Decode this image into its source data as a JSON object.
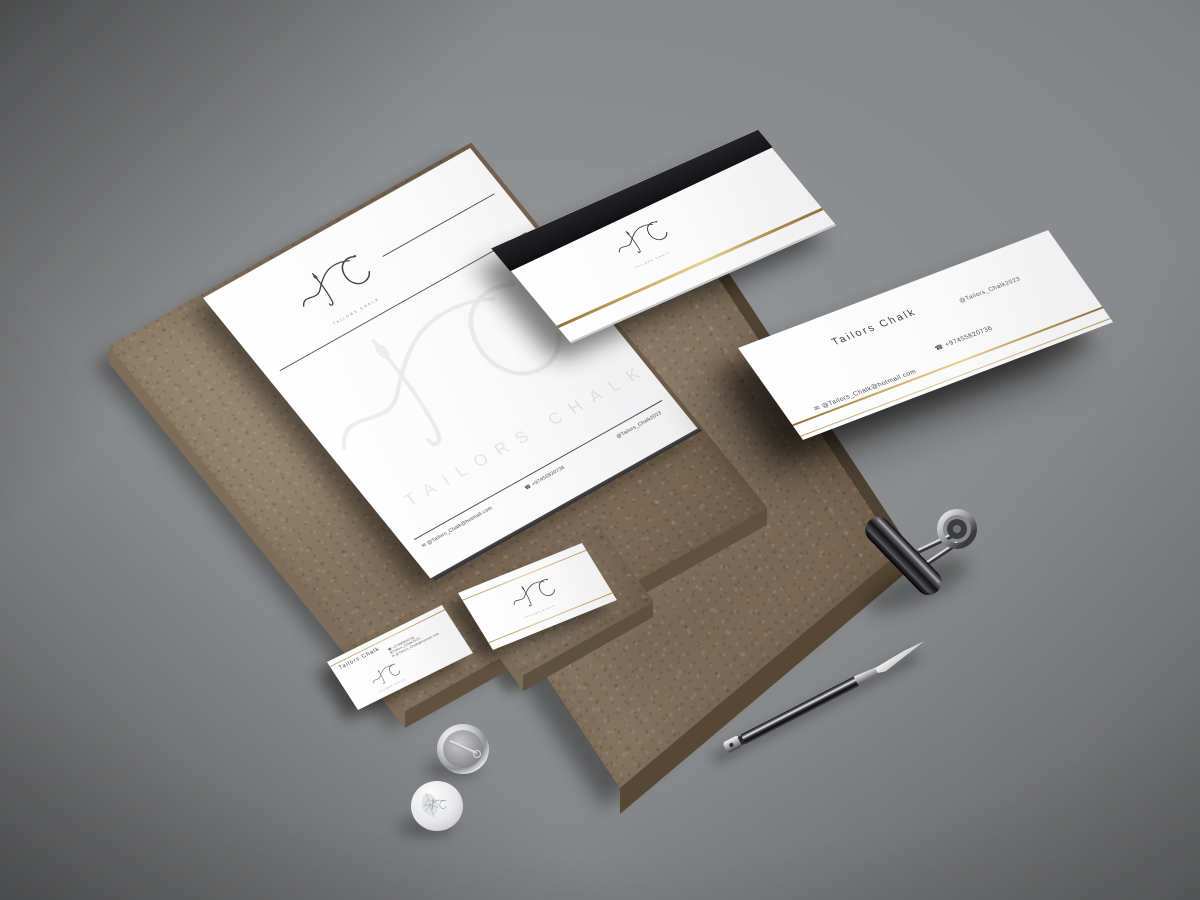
{
  "brand": {
    "name": "Tailors Chalk",
    "monogram": "TC",
    "social_handle": "@Tailors_Chalk2023",
    "phone": "+97455820736",
    "email": "@Tailors_Chalk@hotmail.com"
  },
  "letterhead": {
    "brand_subtitle": "Tailors Chalk",
    "watermark_name": "Tailors Chalk",
    "footer_email": "@Tailors_Chalk@hotmail.com",
    "footer_phone": "+97455820736",
    "footer_social": "@Tailors_Chalk2023"
  },
  "envelope": {
    "brand_subtitle": "Tailors Chalk"
  },
  "business_card_back": {
    "title": "Tailors Chalk",
    "social": "@Tailors_Chalk2023",
    "phone": "+97455820736",
    "email": "@Tailors_Chalk@hotmail.com"
  },
  "business_card_front": {
    "title": "Tailors Chalk",
    "phone": "+97455820736",
    "social": "@Tailors_Chalk2023",
    "email": "@Tailors_Chalk@hotmail.com",
    "brand_subtitle": "Tailors Chalk"
  },
  "business_card_logo_side": {
    "brand_subtitle": "Tailors Chalk"
  },
  "icons": {
    "phone_icon": "☎",
    "email_icon": "✉"
  },
  "colors": {
    "gold": "#c3a25f",
    "paper": "#ffffff",
    "stone": "#8d7b68",
    "background": "#87898b",
    "envelope_flap": "#1c1c1e",
    "ink": "#40414a"
  }
}
